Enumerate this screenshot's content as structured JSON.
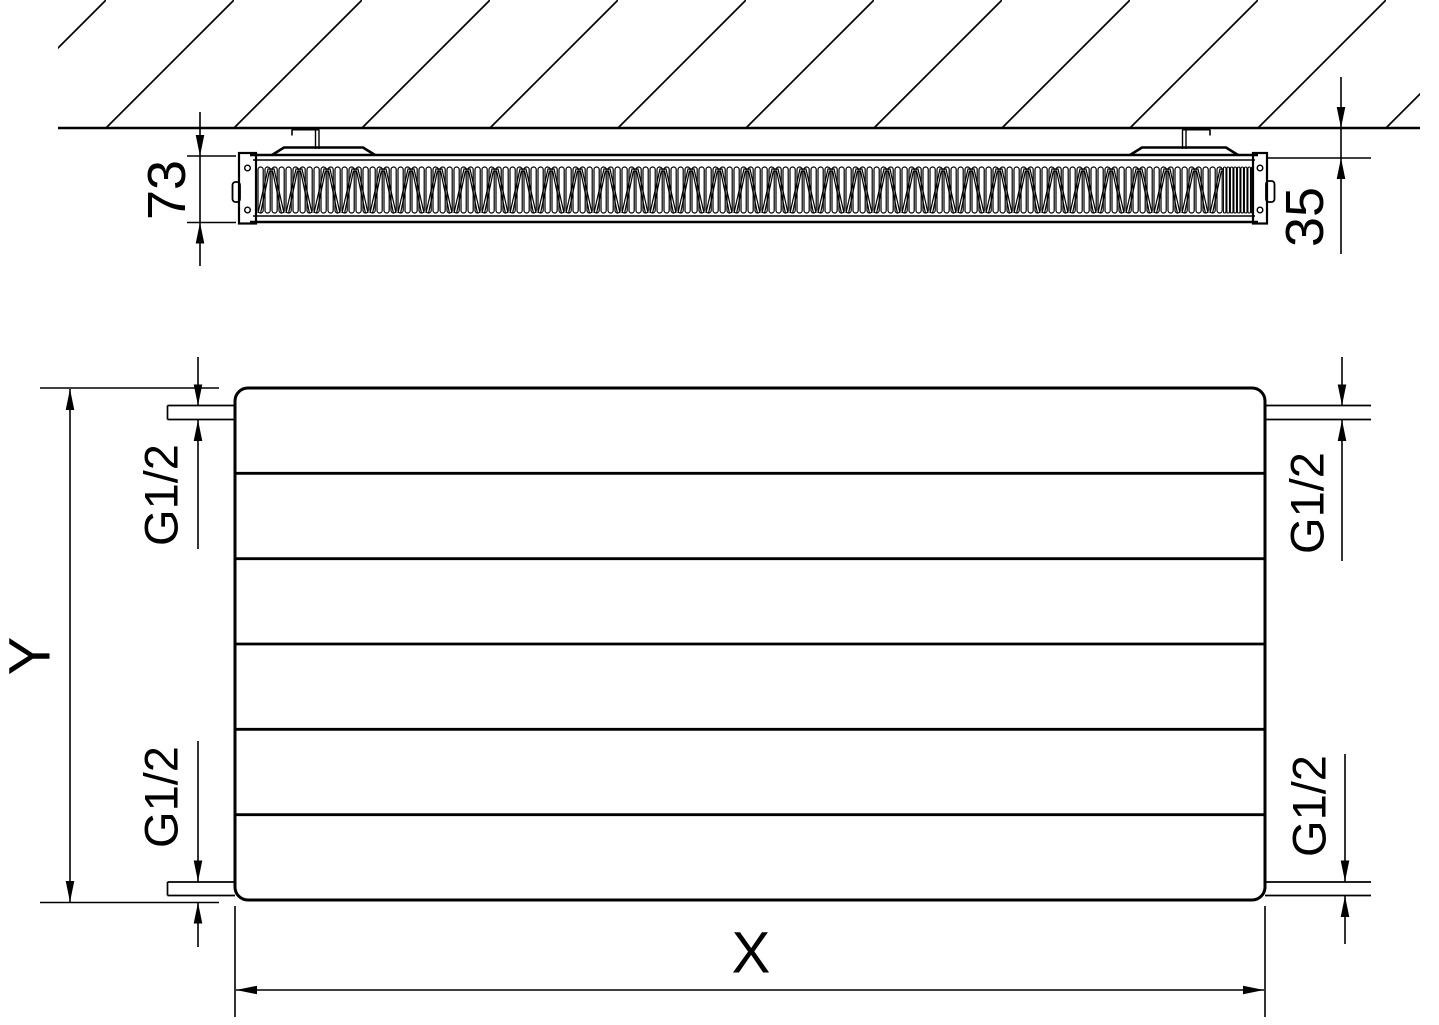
{
  "top_view": {
    "depth_label": "73",
    "wall_clearance_label": "35"
  },
  "front_view": {
    "height_label": "Y",
    "width_label": "X",
    "connection_top_left": "G1/2",
    "connection_bottom_left": "G1/2",
    "connection_top_right": "G1/2",
    "connection_bottom_right": "G1/2"
  },
  "colors": {
    "line": "#000000",
    "background": "#ffffff"
  }
}
